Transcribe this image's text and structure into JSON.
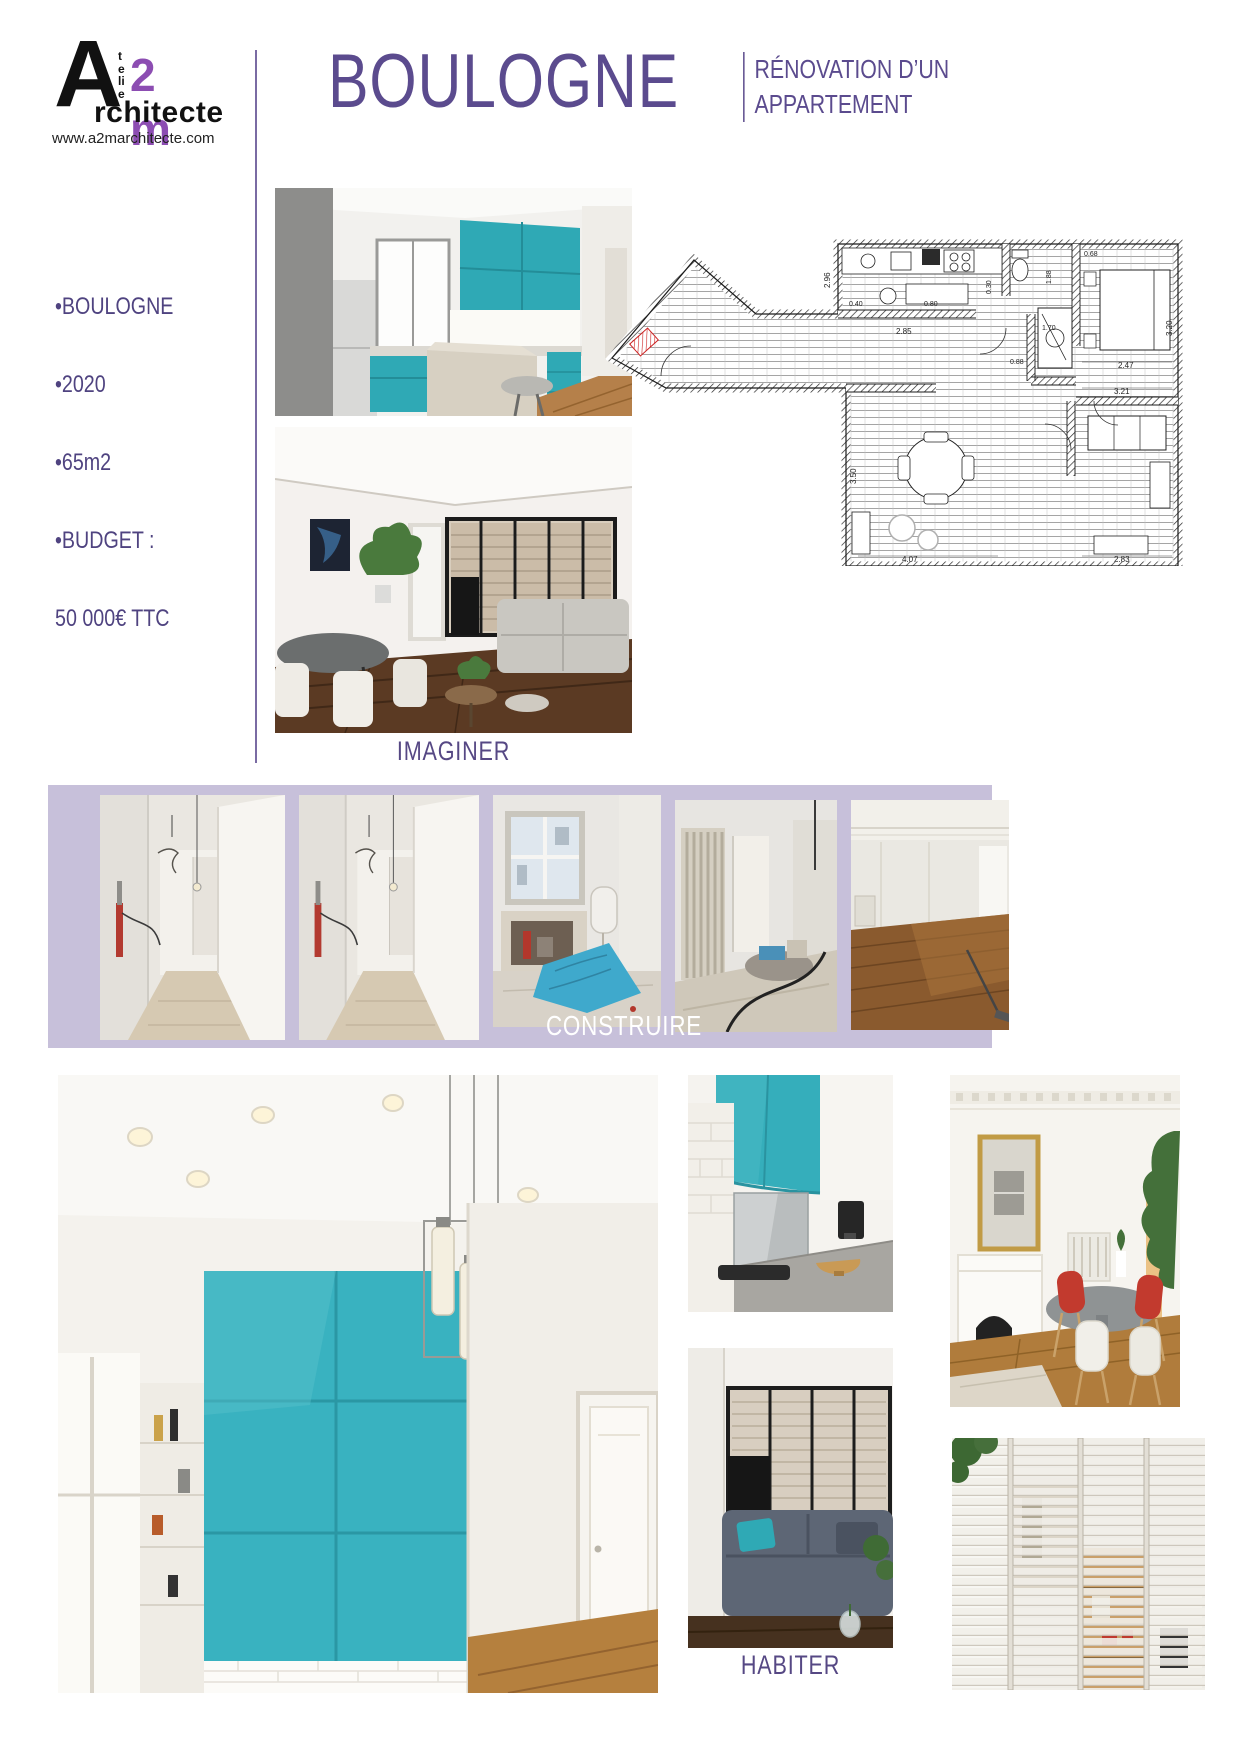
{
  "logo": {
    "letter_a": "A",
    "atelier_vertical": "telie",
    "two_m": "2 m",
    "architecte": "rchitecte",
    "website": "www.a2marchitecte.com"
  },
  "header": {
    "title": "BOULOGNE",
    "subtitle_line1": "RÉNOVATION D’UN",
    "subtitle_line2": "APPARTEMENT"
  },
  "project_info": {
    "items": [
      "•BOULOGNE",
      "•2020",
      "•65m2",
      "•BUDGET :",
      "50 000€ TTC"
    ]
  },
  "sections": {
    "imagine_label": "IMAGINER",
    "build_label": "CONSTRUIRE",
    "live_label": "HABITER"
  },
  "floor_plan": {
    "dims": {
      "kitchen_w": "2.85",
      "kitchen_d": "2.96",
      "top_a": "0.40",
      "top_b": "0.80",
      "small_a": "0.30",
      "bath_h": "1.88",
      "bath_w": "1.70",
      "small_b": "0.88",
      "small_c": "0.68",
      "bed_w": "2.47",
      "bed_h": "3.20",
      "hall_w": "3.21",
      "living_h": "3.50",
      "living_w": "4.07",
      "right_w": "2.83"
    }
  },
  "colors": {
    "accent_purple": "#5b4b8e",
    "logo_purple": "#8c4db2",
    "band_lavender": "#c7c0da",
    "teal": "#2fa9b5"
  }
}
